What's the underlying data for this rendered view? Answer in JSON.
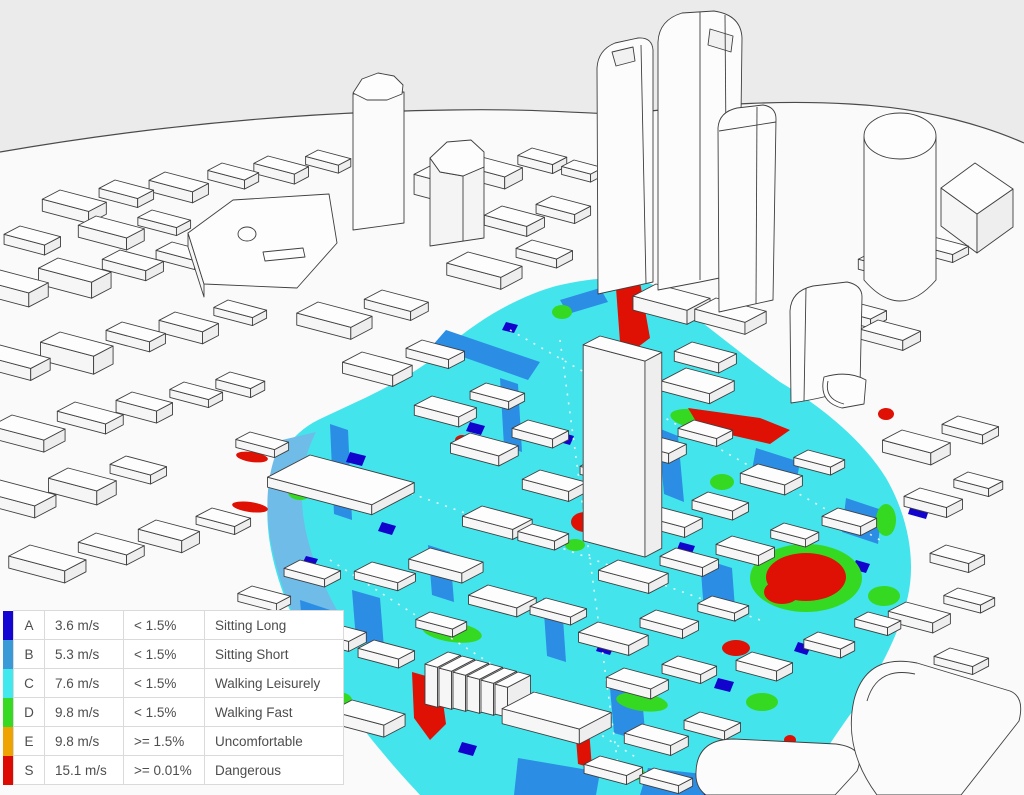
{
  "scene": {
    "description": "3D city model with pedestrian wind comfort overlay",
    "sky_color": "#ecebeb",
    "ground_color": "#fafafa",
    "building_color": "#fdfdfd",
    "outline_color": "#3f3f3f",
    "overlay_colors": {
      "sitting_long": "#1405d2",
      "sitting_short": "#2b8de4",
      "walking_leisurely": "#44e4ec",
      "walking_fast": "#35d921",
      "uncomfortable": "#eea302",
      "dangerous": "#df1004"
    }
  },
  "legend": {
    "rows": [
      {
        "category": "A",
        "speed": "3.6 m/s",
        "frequency": "< 1.5%",
        "activity": "Sitting Long",
        "color": "#1405d2"
      },
      {
        "category": "B",
        "speed": "5.3 m/s",
        "frequency": "< 1.5%",
        "activity": "Sitting Short",
        "color": "#3a9ad8"
      },
      {
        "category": "C",
        "speed": "7.6 m/s",
        "frequency": "< 1.5%",
        "activity": "Walking Leisurely",
        "color": "#41e9ee"
      },
      {
        "category": "D",
        "speed": "9.8 m/s",
        "frequency": "< 1.5%",
        "activity": "Walking Fast",
        "color": "#38d922"
      },
      {
        "category": "E",
        "speed": "9.8 m/s",
        "frequency": ">= 1.5%",
        "activity": "Uncomfortable",
        "color": "#eea302"
      },
      {
        "category": "S",
        "speed": "15.1 m/s",
        "frequency": ">= 0.01%",
        "activity": "Dangerous",
        "color": "#dc0a03"
      }
    ]
  }
}
